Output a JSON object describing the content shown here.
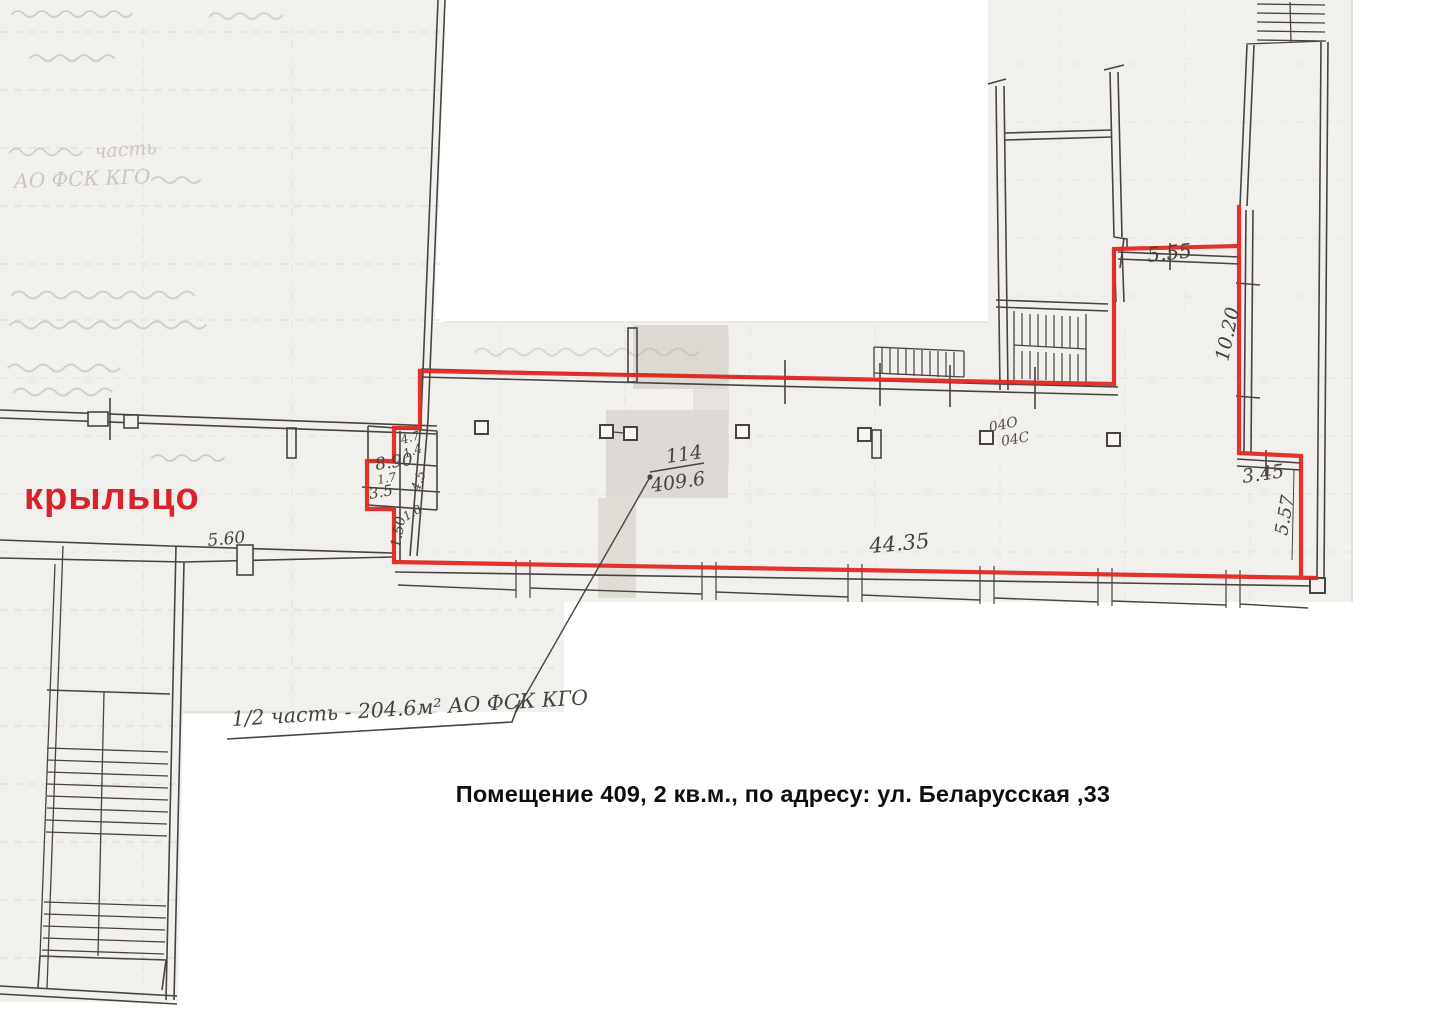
{
  "document_caption": {
    "text": "Помещение 409, 2 кв.м., по адресу: ул. Беларусская ,33"
  },
  "labels": {
    "porch": "крыльцо",
    "area_note": "1/2 часть - 204.6м² АО ФСК КГО",
    "fraction_top": "114",
    "fraction_bottom": "409.6"
  },
  "dimensions": [
    {
      "text": "5.55"
    },
    {
      "text": "10.20"
    },
    {
      "text": "3.45"
    },
    {
      "text": "5.57"
    },
    {
      "text": "44.35"
    },
    {
      "text": "5.60"
    },
    {
      "text": "8.90"
    },
    {
      "text": "1.7"
    },
    {
      "text": "3.5"
    },
    {
      "text": "4.5"
    },
    {
      "text": "4.7"
    },
    {
      "text": "1.4"
    },
    {
      "text": "1.50"
    },
    {
      "text": "1.0"
    }
  ],
  "column_labels": {
    "top": "04О",
    "bottom": "04С"
  },
  "pencil_notes": {
    "line1": "часть",
    "line2": "АО ФСК КГО"
  },
  "colors": {
    "boundary_red": "#e02824",
    "porch_label_red": "#d8232a",
    "ink": "#474440",
    "scan_paper": "#f1f0ec",
    "toner_patch": "#d8d5cf",
    "pencil": "#b0aca1"
  }
}
